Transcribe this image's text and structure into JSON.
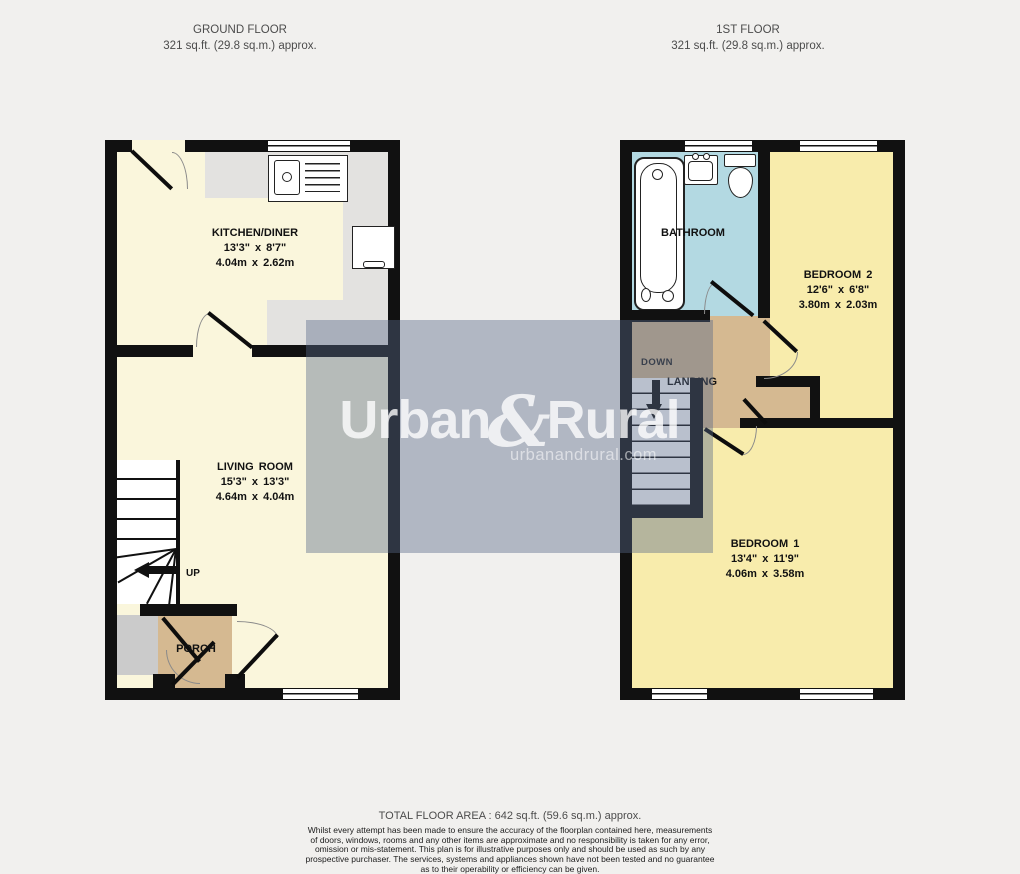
{
  "header": {
    "ground_floor": {
      "title": "GROUND FLOOR",
      "area": "321 sq.ft. (29.8 sq.m.) approx."
    },
    "first_floor": {
      "title": "1ST FLOOR",
      "area": "321 sq.ft. (29.8 sq.m.) approx."
    }
  },
  "ground_floor": {
    "kitchen": {
      "name": "KITCHEN/DINER",
      "size_imperial": "13'3\" x 8'7\"",
      "size_metric": "4.04m x 2.62m"
    },
    "living_room": {
      "name": "LIVING ROOM",
      "size_imperial": "15'3\" x 13'3\"",
      "size_metric": "4.64m x 4.04m"
    },
    "porch": {
      "name": "PORCH"
    },
    "stairs": {
      "direction_label": "UP"
    }
  },
  "first_floor": {
    "bathroom": {
      "name": "BATHROOM"
    },
    "bedroom2": {
      "name": "BEDROOM 2",
      "size_imperial": "12'6\" x 6'8\"",
      "size_metric": "3.80m x 2.03m"
    },
    "bedroom1": {
      "name": "BEDROOM 1",
      "size_imperial": "13'4\" x 11'9\"",
      "size_metric": "4.06m x 3.58m"
    },
    "landing": {
      "name": "LANDING",
      "stairs_direction_label": "DOWN"
    }
  },
  "watermark": {
    "brand_part1": "Urban",
    "brand_amp": "&",
    "brand_part2": "Rural",
    "website": "urbanandrural.com"
  },
  "footer": {
    "total_area": "TOTAL FLOOR AREA : 642 sq.ft. (59.6 sq.m.) approx.",
    "disclaimer_lines": [
      "Whilst every attempt has been made to ensure the accuracy of the floorplan contained here, measurements",
      "of doors, windows, rooms and any other items are approximate and no responsibility is taken for any error,",
      "omission or mis-statement. This plan is for illustrative purposes only and should be used as such by any",
      "prospective purchaser. The services, systems and appliances shown have not been tested and no guarantee",
      "as to their operability or efficiency can be given."
    ],
    "credit": "Made with Metropix ©2026"
  },
  "colors": {
    "wall": "#111111",
    "ground_floor_room": "#FAF6DC",
    "first_floor_room": "#F8ECAC",
    "bathroom": "#B3D9E2",
    "hallway_tan": "#D5B991",
    "worktop_grey": "#E3E2E0",
    "watermark_overlay": "rgba(88,104,136,0.42)"
  }
}
